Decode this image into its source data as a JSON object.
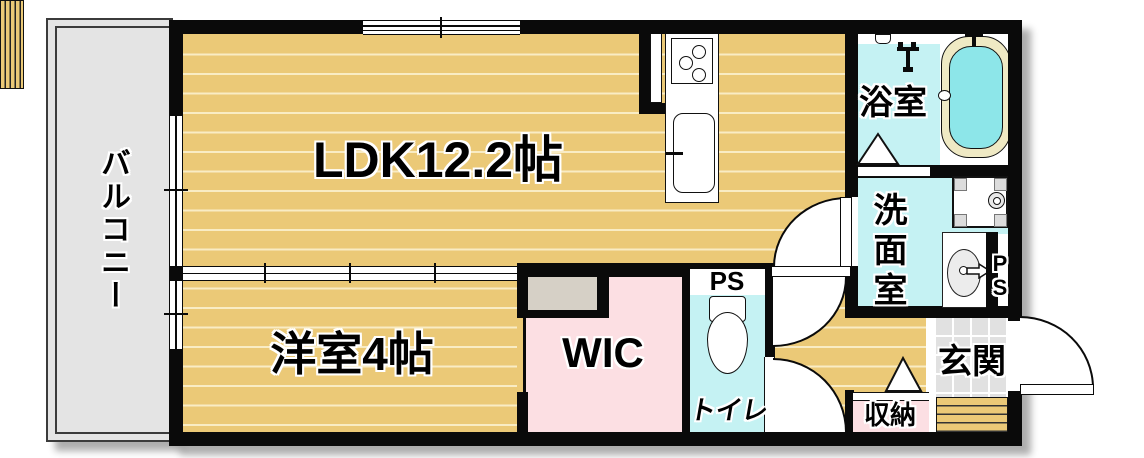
{
  "floorplan": {
    "type": "apartment-madori",
    "labels": {
      "balcony": "バルコニー",
      "ldk": "LDK12.2帖",
      "western_room": "洋室4帖",
      "wic": "WIC",
      "toilet": "トイレ",
      "toilet_ps": "PS",
      "bath": "浴室",
      "washroom": "洗面室",
      "shaft_p": "P",
      "shaft_s": "S",
      "entrance": "玄関",
      "storage": "収納"
    },
    "icons": [
      "kitchen-stove-icon",
      "kitchen-sink-icon",
      "bathtub-icon",
      "shower-icon",
      "wash-bowl-icon",
      "washing-machine-pan-icon",
      "washbasin-icon",
      "toilet-icon",
      "door-swing-arc",
      "door-triangle-marker"
    ],
    "colors": {
      "wall": "#0a0a0a",
      "floor_wood": "#ebc977",
      "floor_line": "#f9ecc4",
      "water_rooms": "#c5f2f3",
      "tub_water": "#8de6e9",
      "tub_rim": "#efe9c4",
      "wic_pink": "#fcdfe3",
      "balcony_gray": "#e4e4e4",
      "tile_gray": "#e1e1e1",
      "nook_gray": "#d6d0c6"
    }
  }
}
